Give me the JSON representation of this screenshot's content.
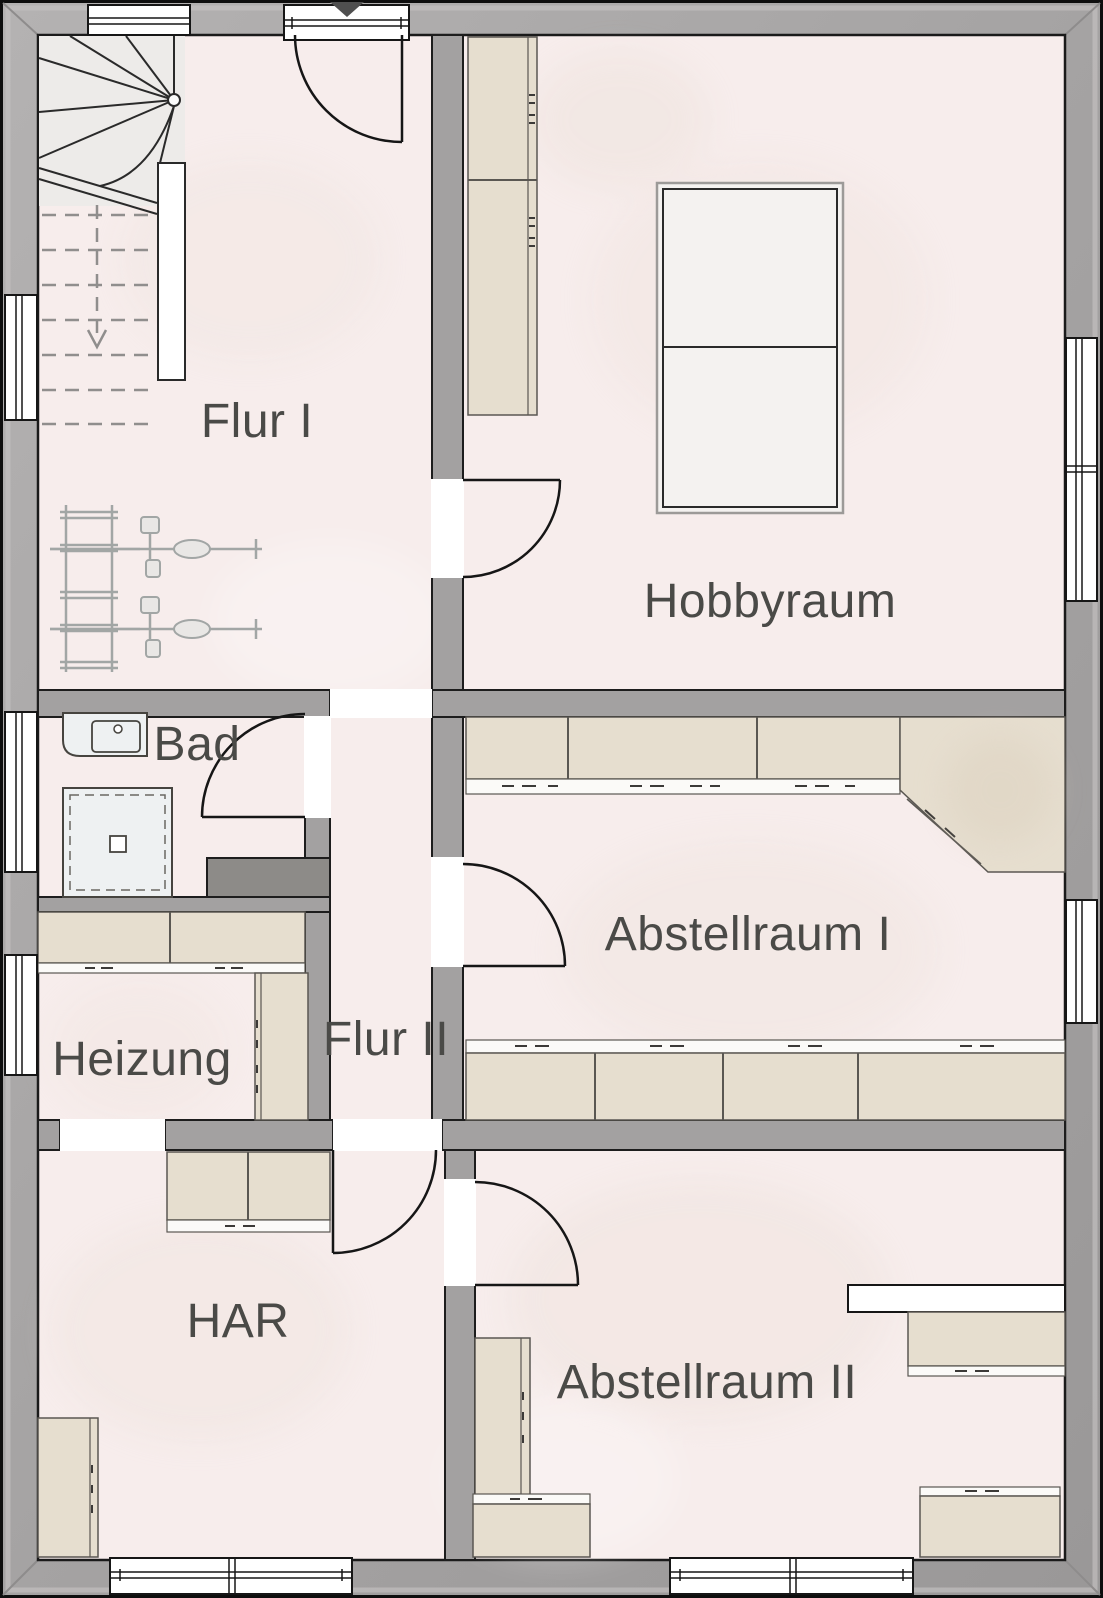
{
  "title": "Basement floor plan",
  "rooms": [
    {
      "id": "flur-1",
      "label": "Flur I"
    },
    {
      "id": "hobbyraum",
      "label": "Hobbyraum"
    },
    {
      "id": "bad",
      "label": "Bad"
    },
    {
      "id": "abstellraum-1",
      "label": "Abstellraum I"
    },
    {
      "id": "heizung",
      "label": "Heizung"
    },
    {
      "id": "flur-2",
      "label": "Flur II"
    },
    {
      "id": "har",
      "label": "HAR"
    },
    {
      "id": "abstellraum-2",
      "label": "Abstellraum II"
    }
  ],
  "fixtures": {
    "staircase": {
      "icon": "stairs-icon",
      "direction_arrow": "down"
    },
    "bicycles": {
      "icon": "bicycle-icon",
      "count": 2,
      "rack": "bike-rack"
    },
    "bathroom": {
      "washbasin": "washbasin-icon",
      "shower": "shower-icon"
    },
    "hobby_table": "table",
    "entrance_marker": "down-triangle-icon",
    "swing_doors": 6,
    "windows": 8,
    "cabinet_runs": 12
  },
  "colors": {
    "exterior_wall": "#a7a5a5",
    "interior_wall": "#a3a1a1",
    "floor": "#f7edec",
    "stair_floor": "#edebe9",
    "cabinet": "#e6decf",
    "sanitary": "#eef1f2",
    "duct_block": "#8d8b88",
    "line": "#1d1d1d",
    "label_text": "#4a4a47",
    "window_white": "#ffffff"
  }
}
